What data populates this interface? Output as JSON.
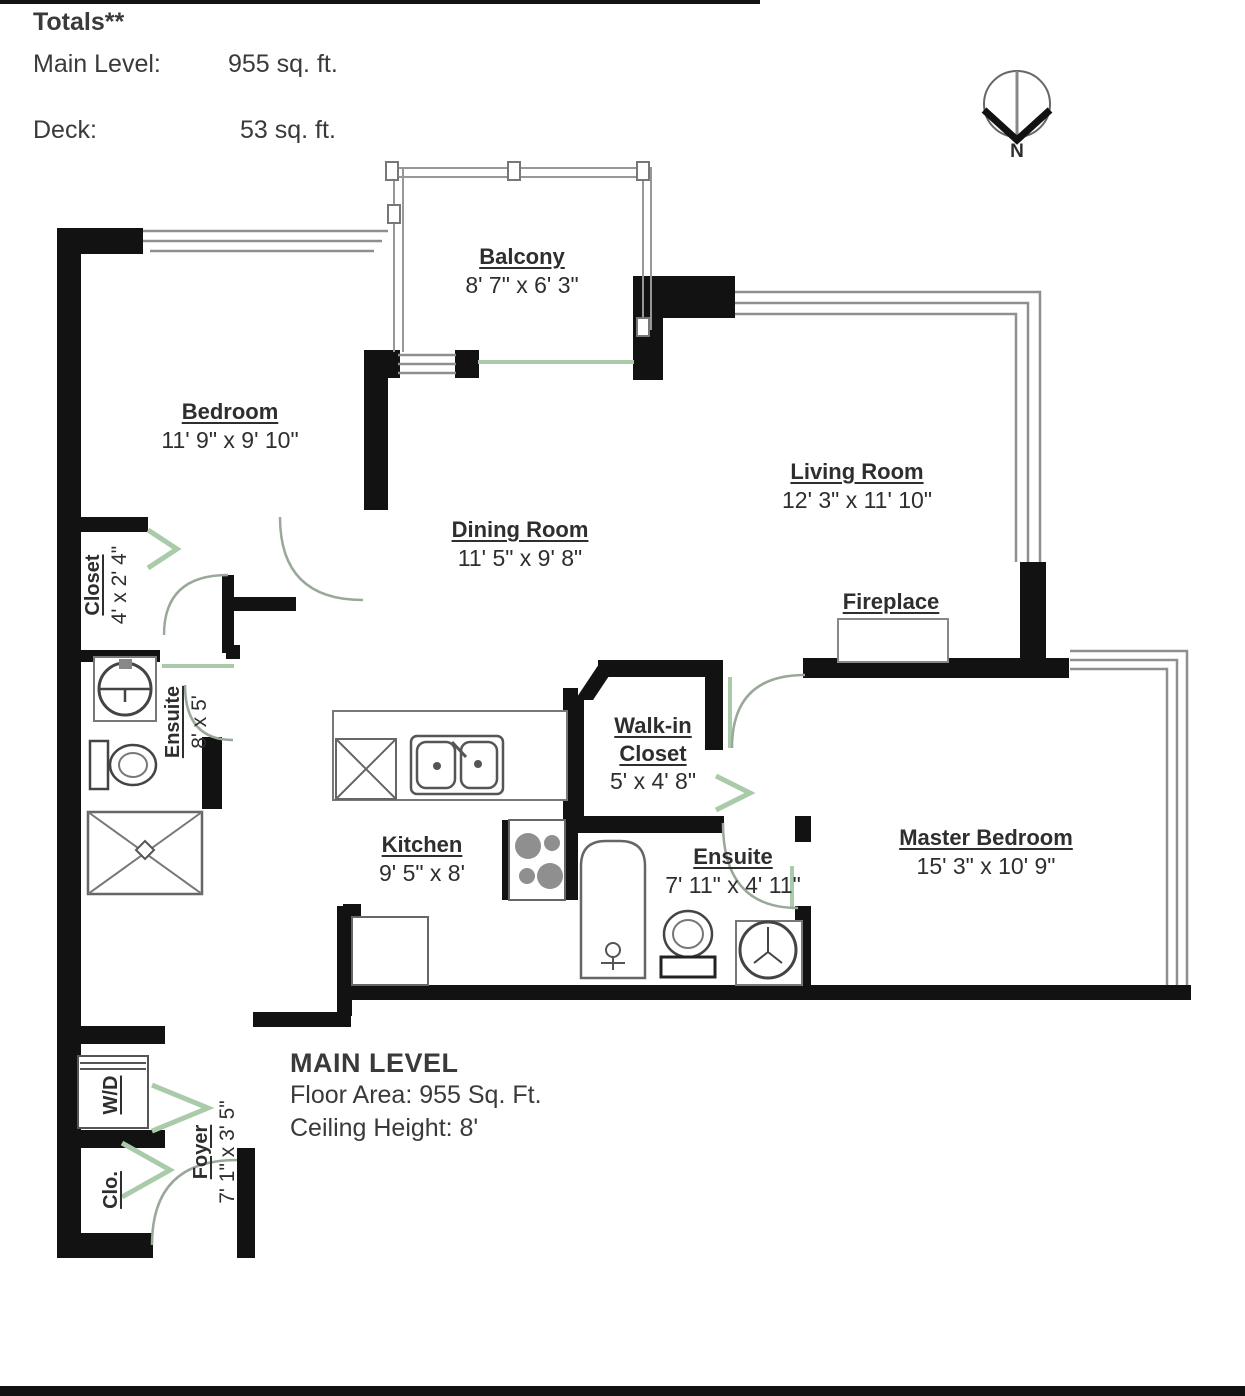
{
  "header": {
    "totals_label": "Totals**",
    "main_level_label": "Main Level:",
    "main_level_value": "955 sq. ft.",
    "deck_label": "Deck:",
    "deck_value": "53 sq. ft."
  },
  "compass": {
    "label": "N"
  },
  "rooms": {
    "balcony": {
      "name": "Balcony",
      "dims": "8' 7\" x 6' 3\""
    },
    "bedroom": {
      "name": "Bedroom",
      "dims": "11' 9\" x 9' 10\""
    },
    "living_room": {
      "name": "Living Room",
      "dims": "12' 3\" x 11' 10\""
    },
    "dining_room": {
      "name": "Dining Room",
      "dims": "11' 5\" x 9' 8\""
    },
    "closet": {
      "name": "Closet",
      "dims": "4' x 2' 4\""
    },
    "ensuite": {
      "name": "Ensuite",
      "dims": "8' x 5'"
    },
    "fireplace": {
      "name": "Fireplace"
    },
    "walk_in_closet": {
      "name_line1": "Walk-in",
      "name_line2": "Closet",
      "dims": "5' x 4' 8\""
    },
    "kitchen": {
      "name": "Kitchen",
      "dims": "9' 5\" x 8'"
    },
    "master_ensuite": {
      "name": "Ensuite",
      "dims": "7' 11\" x 4' 11\""
    },
    "master_bedroom": {
      "name": "Master Bedroom",
      "dims": "15' 3\" x 10' 9\""
    },
    "washer_dryer": {
      "name": "W/D"
    },
    "foyer_closet": {
      "name": "Clo."
    },
    "foyer": {
      "name": "Foyer",
      "dims": "7' 1\" x 3' 5\""
    }
  },
  "footer": {
    "level_name": "MAIN LEVEL",
    "floor_area": "Floor Area: 955 Sq. Ft.",
    "ceiling_height": "Ceiling Height: 8'"
  },
  "colors": {
    "wall": "#121212",
    "window": "#8f8f8f",
    "door_green": "#a9cba9",
    "door_arc": "#9aa89a",
    "fixture": "#555555",
    "text": "#2e2e2e"
  }
}
